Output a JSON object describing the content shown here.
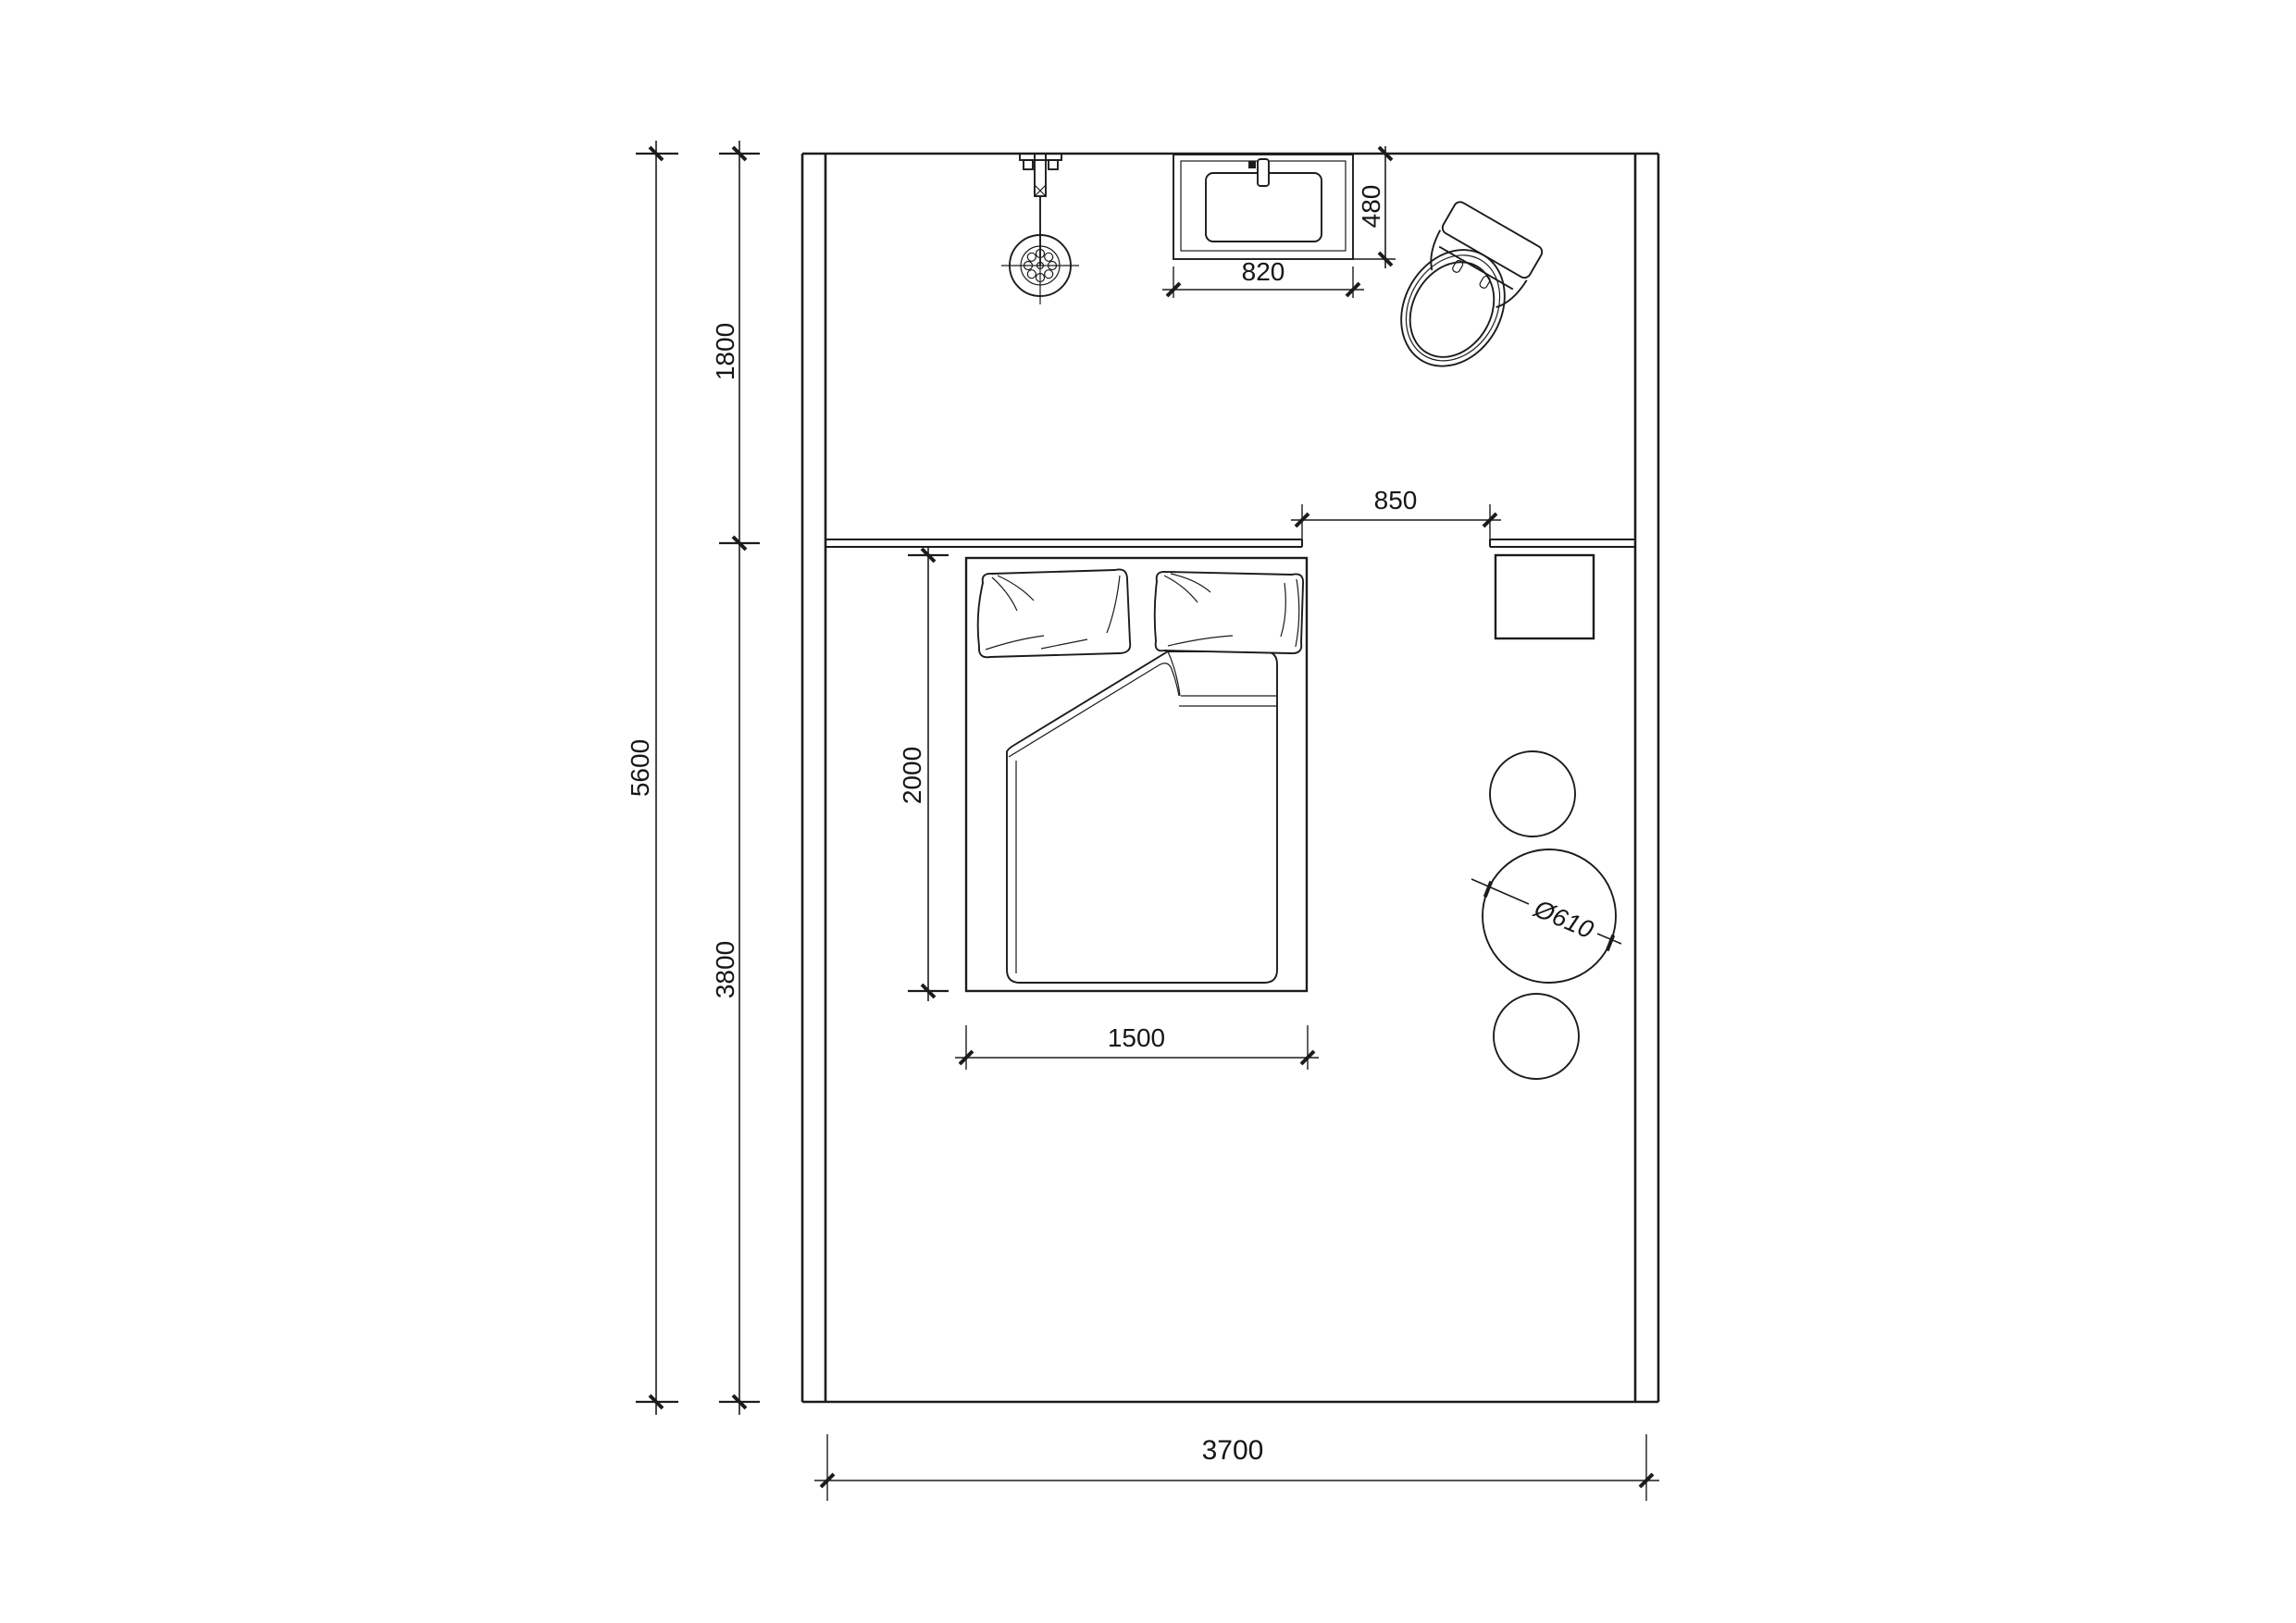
{
  "title": "bedroom and bathroom floor plan",
  "colors": {
    "line": "#1c1c1c",
    "background": "#ffffff"
  },
  "dimensions": {
    "total_depth": "5600",
    "upper_zone_depth": "1800",
    "lower_zone_depth": "3800",
    "total_width": "3700",
    "wall_opening": "850",
    "basin_width": "820",
    "basin_depth": "480",
    "bed_length": "2000",
    "bed_width": "1500",
    "stool_diameter": "Ø610"
  },
  "fixtures": {
    "shower": "shower-head",
    "basin": "washbasin",
    "toilet": "toilet",
    "bed": "double-bed",
    "table": "side-table",
    "stools": "round-stools"
  }
}
